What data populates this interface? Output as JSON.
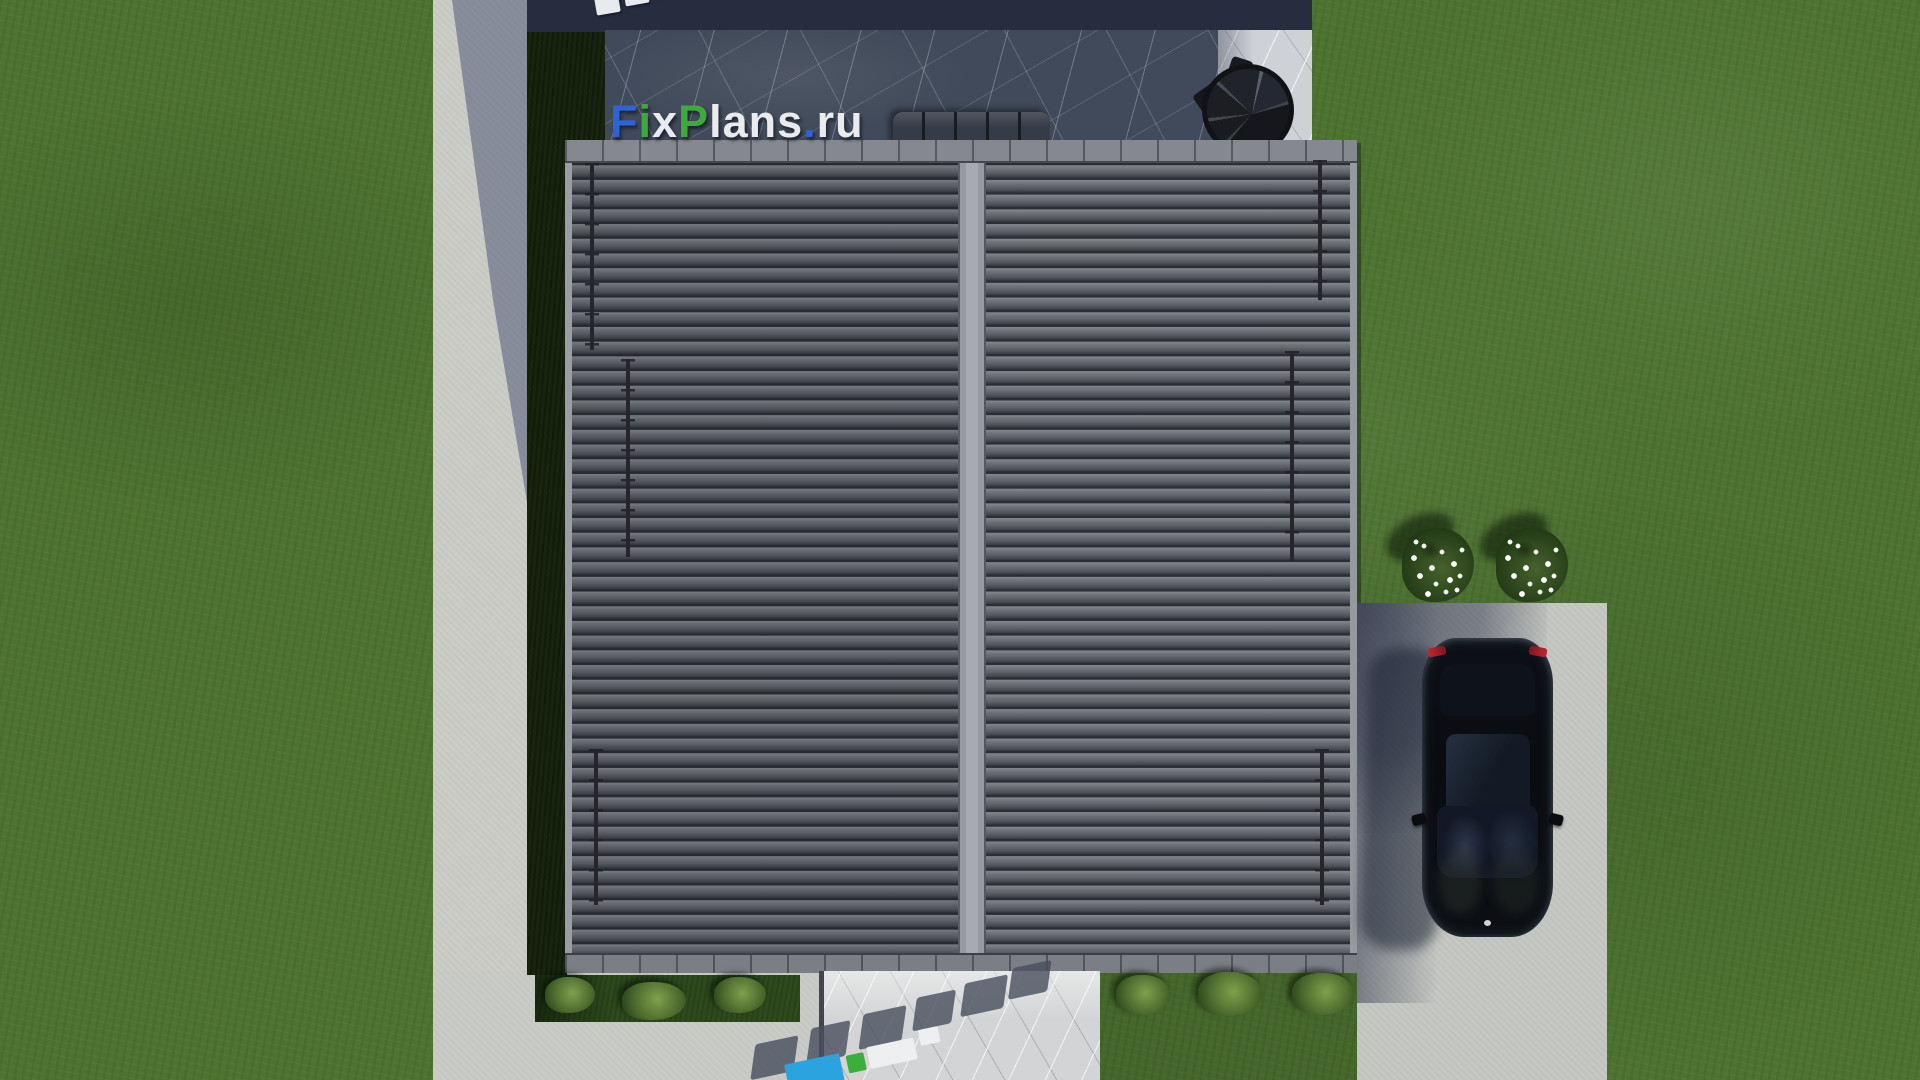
{
  "watermark": {
    "text": "FixPlans.ru",
    "letters": [
      {
        "ch": "F",
        "color": "#2e63d6"
      },
      {
        "ch": "i",
        "color": "#3dab3b"
      },
      {
        "ch": "x",
        "color": "#e9ebee"
      },
      {
        "ch": "P",
        "color": "#3dab3b"
      },
      {
        "ch": "l",
        "color": "#e9ebee"
      },
      {
        "ch": "a",
        "color": "#e9ebee"
      },
      {
        "ch": "n",
        "color": "#e9ebee"
      },
      {
        "ch": "s",
        "color": "#e9ebee"
      },
      {
        "ch": ".",
        "color": "#2e63d6"
      },
      {
        "ch": "r",
        "color": "#e9ebee"
      },
      {
        "ch": "u",
        "color": "#e9ebee"
      }
    ]
  },
  "scene": {
    "description": "Top-down 3D render of a house: dark tiled double-pitch roof with central ridge, stone terrace with outdoor sofa and spiral staircase, concrete footpath and plaza, marble walkway, driveway with parked black car, lawn with flowering shrubs and bushes",
    "colors": {
      "grass": "#4d7330",
      "grass_shadow": "#17250f",
      "path_concrete": "#cbccc6",
      "plaza_concrete": "#c9cbc6",
      "driveway_concrete": "#c5c7c2",
      "terrace_navy_shadow": "#262d3e",
      "terrace_dark_marble": "#414a5a",
      "terrace_light_marble": "#ced2d7",
      "walkway_marble": "#d2d4d5",
      "roof_tile": "#64676d",
      "roof_ridge": "#989ca2",
      "roof_fascia": "#85888e",
      "sofa": "#353b47",
      "staircase": "#15171c",
      "car_body": "#0b0d11",
      "car_taillight": "#a02128",
      "flowers": "#ffffff",
      "logo_blue": "#2e63d6",
      "logo_green": "#3dab3b",
      "logo_cyan": "#2aa3de",
      "logo_white": "#edeff1"
    }
  }
}
